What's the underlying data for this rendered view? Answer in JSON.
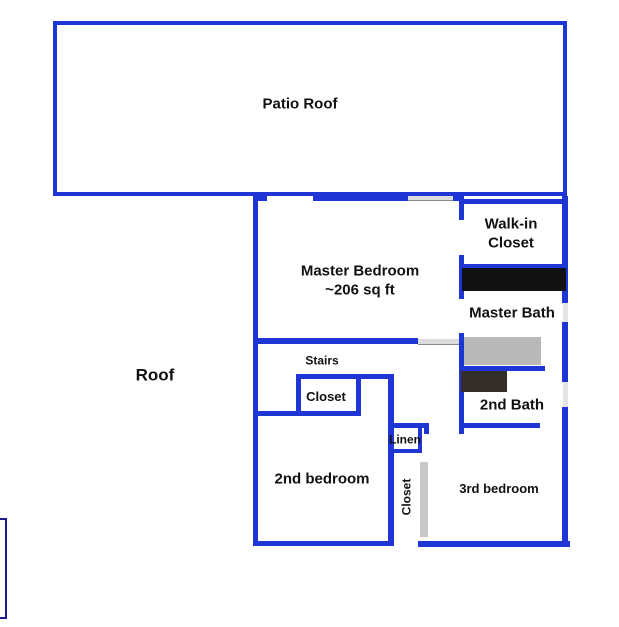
{
  "title": "Second floor plan",
  "rooms": {
    "patio_roof": {
      "label": "Patio Roof"
    },
    "master_bedroom": {
      "label": "Master Bedroom",
      "area": "~206 sq ft"
    },
    "walk_in_closet": {
      "label_line1": "Walk-in",
      "label_line2": "Closet"
    },
    "master_bath": {
      "label": "Master Bath"
    },
    "roof": {
      "label": "Roof"
    },
    "stairs": {
      "label": "Stairs"
    },
    "hall_closet": {
      "label": "Closet"
    },
    "second_bath": {
      "label": "2nd Bath"
    },
    "second_bedroom": {
      "label": "2nd bedroom"
    },
    "linen": {
      "label": "Linen"
    },
    "bedroom_closet": {
      "label": "Closet"
    },
    "third_bedroom": {
      "label": "3rd bedroom"
    }
  },
  "colors": {
    "wall_blue": "#1f35d4",
    "outline_navy": "#1b1b8e",
    "fixture_black": "#111111",
    "fixture_gray": "#b9b9b9",
    "fixture_dark": "#342e2b",
    "door_marker_gray": "#dcdcdc",
    "window_marker_gray": "#e4e4e4",
    "closet_door_gray": "#c9c9c9"
  }
}
